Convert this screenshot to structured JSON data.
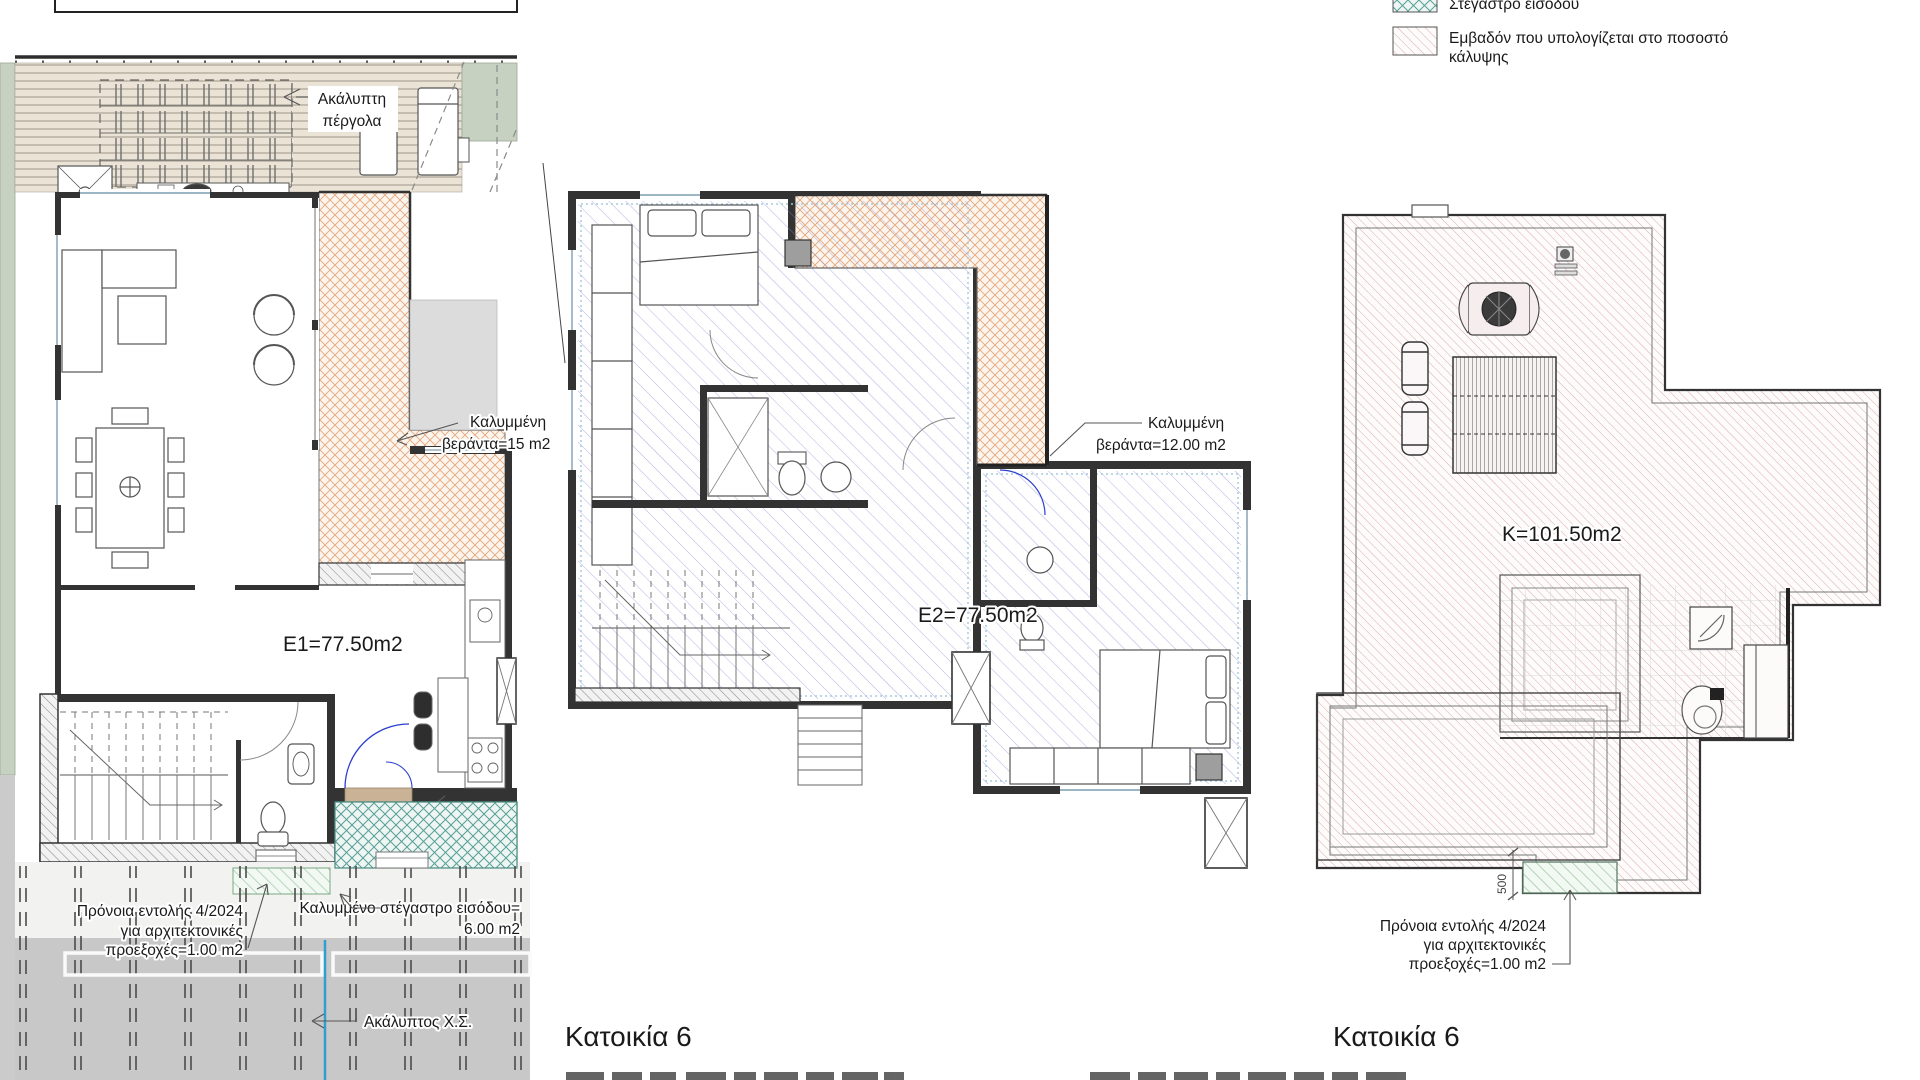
{
  "legend": {
    "item1_label": "Στέγαστρο εισόδου",
    "item2_line1": "Εμβαδόν που υπολογίζεται στο ποσοστό",
    "item2_line2": "κάλυψης"
  },
  "ground_floor": {
    "area": "E1=77.50m2",
    "pergola_line1": "Ακάλυπτη",
    "pergola_line2": "πέργολα",
    "veranda_line1": "Καλυμμένη",
    "veranda_line2": "βεράντα=15 m2",
    "canopy_line1": "Καλυμμένο στέγαστρο εισόδου=",
    "canopy_line2": "6.00 m2",
    "canopy_dim": "1600",
    "provision_line1": "Πρόνοια εντολής 4/2024",
    "provision_line2": "για αρχιτεκτονικές",
    "provision_line3": "προεξοχές=1.00 m2",
    "yard_label": "Ακάλυπτος Χ.Σ."
  },
  "first_floor": {
    "area": "E2=77.50m2",
    "veranda_line1": "Καλυμμένη",
    "veranda_line2": "βεράντα=12.00 m2",
    "title": "Κατοικία 6"
  },
  "roof": {
    "area": "K=101.50m2",
    "provision_line1": "Πρόνοια εντολής 4/2024",
    "provision_line2": "για αρχιτεκτονικές",
    "provision_line3": "προεξοχές=1.00 m2",
    "dim": "500",
    "title": "Κατοικία 6"
  },
  "colors": {
    "veranda_hatch": "#e4a77c",
    "entrance_canopy_hatch": "#55a097",
    "roof_hatch": "#d4a2b0",
    "provision_hatch": "#92bf9a",
    "upper_floor_overlay_hatch": "#8b8bd0",
    "deck": "#ebe4d6",
    "garden": "#c7d1c1",
    "yard_gray": "#c8c8c8",
    "plot_blue_line": "#2f9fd2"
  }
}
